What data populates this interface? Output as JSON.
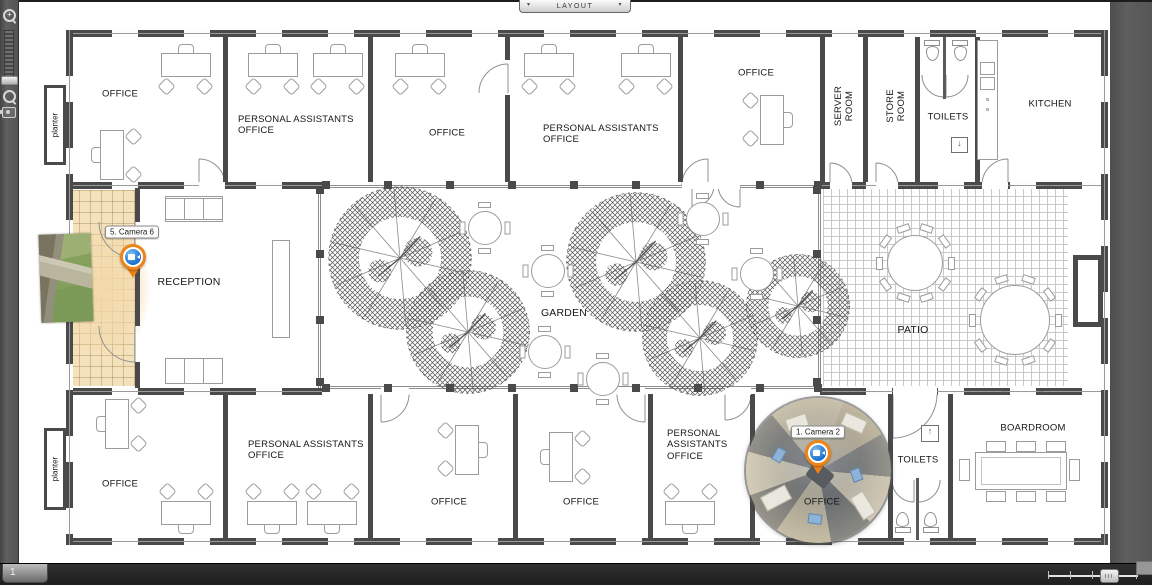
{
  "header": {
    "layout_label": "LAYOUT"
  },
  "side_toolbar": {
    "icons": [
      "zoom-in",
      "zoom-slider",
      "zoom-out",
      "camera-view"
    ]
  },
  "bottom_bar": {
    "tab_label": "1"
  },
  "cameras": [
    {
      "label": "5. Camera 6"
    },
    {
      "label": "1. Camera 2"
    }
  ],
  "rooms": {
    "planter_top": "planter",
    "planter_bottom": "planter",
    "office_top_1": "OFFICE",
    "pa_office_top_1": "PERSONAL ASSISTANTS OFFICE",
    "office_top_2": "OFFICE",
    "pa_office_top_2": "PERSONAL ASSISTANTS OFFICE",
    "office_top_3": "OFFICE",
    "server_room": "SERVER ROOM",
    "store_room": "STORE ROOM",
    "toilets_top": "TOILETS",
    "kitchen": "KITCHEN",
    "reception": "RECEPTION",
    "garden": "GARDEN",
    "patio": "PATIO",
    "office_bottom_1": "OFFICE",
    "pa_office_bottom_1": "PERSONAL ASSISTANTS OFFICE",
    "office_bottom_2": "OFFICE",
    "office_bottom_3": "OFFICE",
    "pa_office_bottom_2": "PERSONAL ASSISTANTS OFFICE",
    "office_bottom_4": "OFFICE",
    "toilets_bottom": "TOILETS",
    "boardroom": "BOARDROOM"
  },
  "colors": {
    "pin_orange": "#ef8318",
    "camera_icon_blue": "#1a6fc9",
    "wall": "#4a4a4a",
    "camera_fov_beige": "#f3e1bd"
  }
}
